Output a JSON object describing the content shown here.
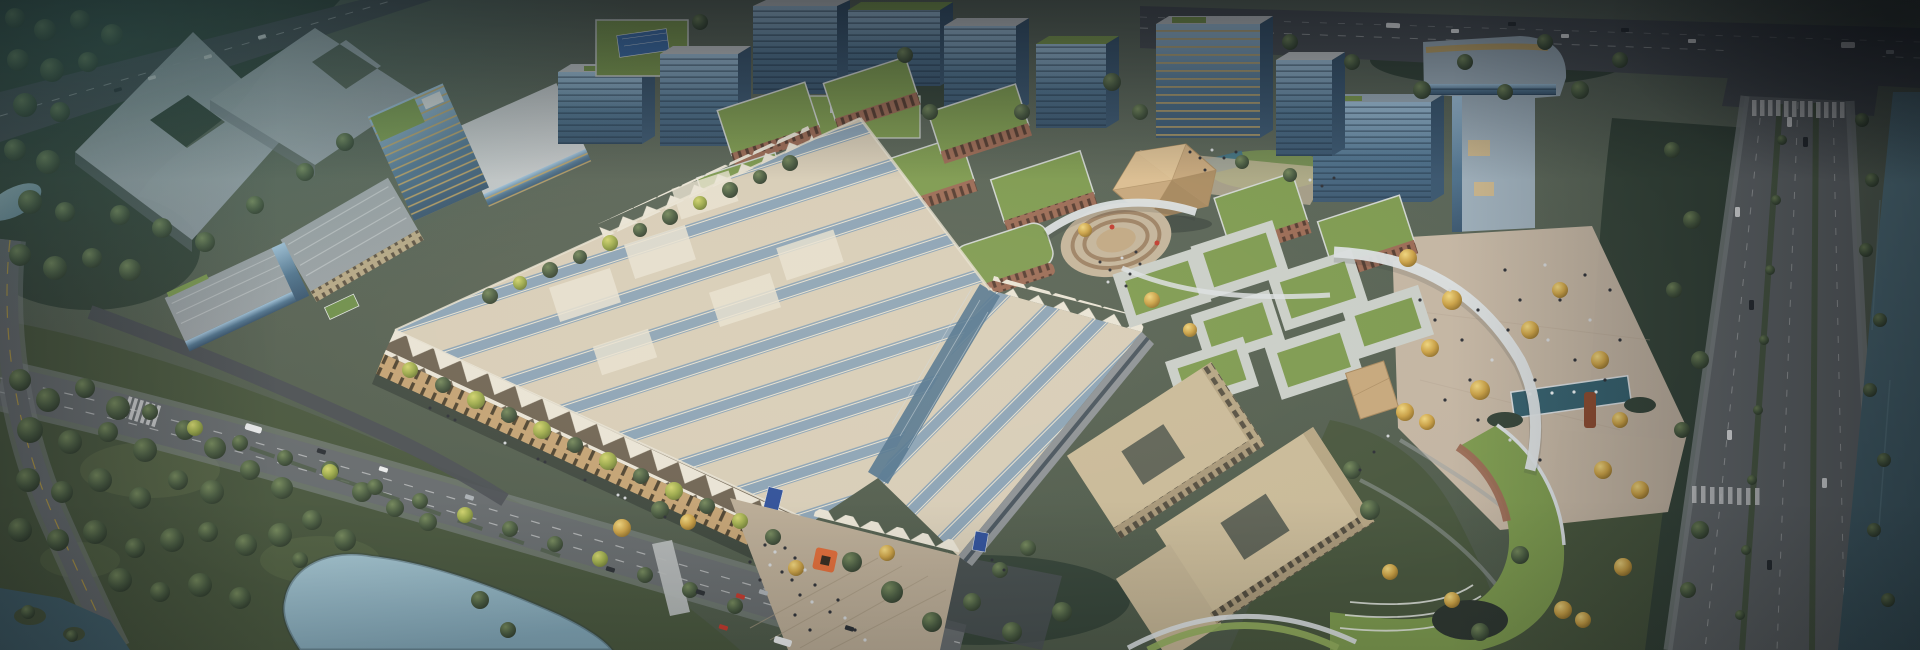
{
  "scene": {
    "title": "Aerial architectural rendering of a mixed-use exhibition and office campus at dusk",
    "type": "architectural-aerial-rendering",
    "landmarks": [
      "exhibition-hall-sawtooth-roof",
      "exhibition-entrance-plaza",
      "orange-ring-sculpture",
      "entrance-sign-blue",
      "golden-faceted-dome",
      "sunken-amphitheater",
      "white-canopy-arcs",
      "green-roof-courtyard-pavilions",
      "brick-office-buildings",
      "glass-office-towers",
      "gold-striped-tower",
      "courtyard-office-complex",
      "terraced-crescent-building",
      "pedestrian-plaza-with-fountain",
      "rust-chimney-sculpture",
      "ghost-massing-blocks",
      "industrial-sheds",
      "boulevard",
      "canal",
      "highway",
      "park",
      "pond"
    ]
  },
  "palette": {
    "ground_base": "#56614f",
    "park_green": "#49573f",
    "forest_dark": "#36453a",
    "grass_light": "#5c6b4a",
    "asphalt": "#666b6e",
    "asphalt_dark": "#4b5055",
    "sidewalk": "#82888a",
    "road_line": "#d9dbdc",
    "road_yellow": "#c2a23e",
    "median_green": "#4e5d48",
    "water_light": "#a4c4d0",
    "water_mid": "#7fa3b4",
    "water_dark": "#44626e",
    "canal_dark": "#3f5a66",
    "ghost_top": "#b9c2c7",
    "ghost_body": "#8e979e",
    "ghost_dark": "#6f787f",
    "glass_hi": "#9fc0d8",
    "glass_mid": "#51748f",
    "glass_dark": "#3a566f",
    "glass_stripe_gold": "#c2a360",
    "roof_light": "#c3c7c9",
    "roof_gray": "#9aa1a5",
    "roof_blue_gray": "#9cadb9",
    "green_roof": "#7d9a50",
    "green_roof_hi": "#94ae5e",
    "solar_blue": "#3e6ea8",
    "brick": "#9a6a55",
    "brick_dark": "#7c5244",
    "hall_beige": "#d7cdb8",
    "hall_beige_hi": "#e8e2d2",
    "hall_blue": "#8ba3b6",
    "hall_tooth": "#e9e4d6",
    "hall_tooth_shadow": "#6e6353",
    "hall_facade": "#c3a274",
    "hall_facade_dark": "#4e4330",
    "canopy_white": "#dadfe2",
    "colonnade": "#8d9296",
    "deck_wood": "#b9ab96",
    "deck_line": "#a3957f",
    "plaza_warm": "#c9b9a8",
    "plaza_tan": "#c3b49b",
    "amph_step": "#9c8164",
    "dome_hi": "#dcc094",
    "dome_mid": "#c6a77c",
    "dome_dark": "#a5875e",
    "beige_bldg": "#c9ba99",
    "beige_facade": "#a8987a",
    "court_dark": "#5f6357",
    "ring_frame": "#c9cec9",
    "sign_blue": "#2e4f9a",
    "accent_orange": "#dd6a38",
    "accent_red": "#c03a2e",
    "rust_tower": "#8a4a30",
    "people_dark": "#2e3138",
    "people_light": "#d2d5d8",
    "car_white": "#e9ebec",
    "car_dark": "#2c3136",
    "car_silver": "#aab0b5"
  }
}
